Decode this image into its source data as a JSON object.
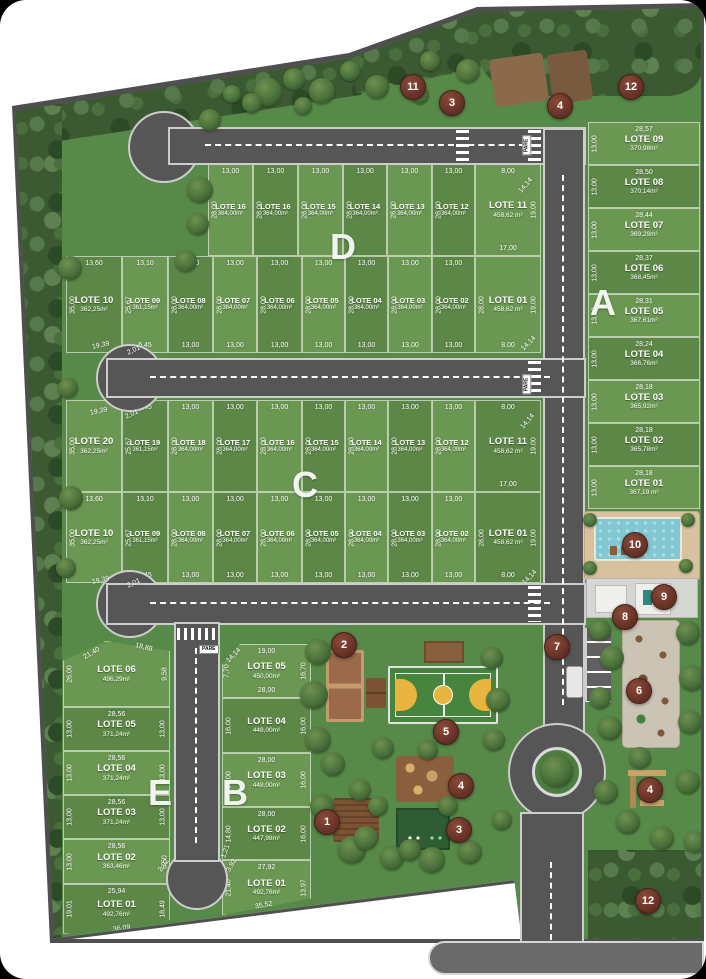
{
  "site": {
    "pare_label": "PARE"
  },
  "blocks": [
    {
      "letter": "A",
      "lx": 590,
      "ly": 282,
      "lots": [
        {
          "n": "LOTE 09",
          "a": "370,98m²",
          "t": "28,57",
          "l": "13,00",
          "x": 588,
          "y": 122,
          "w": 112,
          "h": 43
        },
        {
          "n": "LOTE 08",
          "a": "370,14m²",
          "t": "28,50",
          "l": "13,00",
          "x": 588,
          "y": 165,
          "w": 112,
          "h": 43
        },
        {
          "n": "LOTE 07",
          "a": "369,29m²",
          "t": "28,44",
          "l": "13,00",
          "x": 588,
          "y": 208,
          "w": 112,
          "h": 43
        },
        {
          "n": "LOTE 06",
          "a": "368,45m²",
          "t": "28,37",
          "l": "13,00",
          "x": 588,
          "y": 251,
          "w": 112,
          "h": 43
        },
        {
          "n": "LOTE 05",
          "a": "367,61m²",
          "t": "28,31",
          "l": "13,00",
          "x": 588,
          "y": 294,
          "w": 112,
          "h": 43
        },
        {
          "n": "LOTE 04",
          "a": "366,76m²",
          "t": "28,24",
          "l": "13,00",
          "x": 588,
          "y": 337,
          "w": 112,
          "h": 43
        },
        {
          "n": "LOTE 03",
          "a": "365,92m²",
          "t": "28,18",
          "l": "13,00",
          "x": 588,
          "y": 380,
          "w": 112,
          "h": 43
        },
        {
          "n": "LOTE 02",
          "a": "365,78m²",
          "t": "28,18",
          "l": "13,00",
          "x": 588,
          "y": 423,
          "w": 112,
          "h": 43
        },
        {
          "n": "LOTE 01",
          "a": "367,19 m²",
          "t": "28,18",
          "l": "13,00",
          "x": 588,
          "y": 466,
          "w": 112,
          "h": 43
        }
      ]
    },
    {
      "letter": "D",
      "lx": 330,
      "ly": 226,
      "lots": [
        {
          "n": "LOTE 16",
          "a": "364,00m²",
          "t": "13,00",
          "l": "28,00",
          "x": 208,
          "y": 164,
          "w": 45,
          "h": 92
        },
        {
          "n": "LOTE 16",
          "a": "364,00m²",
          "t": "13,00",
          "l": "28,00",
          "x": 253,
          "y": 164,
          "w": 45,
          "h": 92
        },
        {
          "n": "LOTE 15",
          "a": "364,00m²",
          "t": "13,00",
          "l": "28,00",
          "x": 298,
          "y": 164,
          "w": 45,
          "h": 92
        },
        {
          "n": "LOTE 14",
          "a": "364,00m²",
          "t": "13,00",
          "l": "28,00",
          "x": 343,
          "y": 164,
          "w": 44,
          "h": 92
        },
        {
          "n": "LOTE 13",
          "a": "364,00m²",
          "t": "13,00",
          "l": "28,00",
          "x": 387,
          "y": 164,
          "w": 45,
          "h": 92
        },
        {
          "n": "LOTE 12",
          "a": "364,00m²",
          "t": "13,00",
          "l": "28,00",
          "x": 432,
          "y": 164,
          "w": 43,
          "h": 92
        },
        {
          "n": "LOTE 11",
          "a": "458,62 m²",
          "t": "8,00",
          "r": "19,00",
          "b": "17,00",
          "x": 475,
          "y": 164,
          "w": 66,
          "h": 92
        },
        {
          "n": "LOTE 10",
          "a": "362,25m²",
          "t": "13,60",
          "l": "35,00",
          "x": 66,
          "y": 256,
          "w": 56,
          "h": 97
        },
        {
          "n": "LOTE 09",
          "a": "361,15m²",
          "t": "13,10",
          "l": "25,67",
          "b": "6,45",
          "x": 122,
          "y": 256,
          "w": 46,
          "h": 97
        },
        {
          "n": "LOTE 08",
          "a": "364,00m²",
          "t": "13,00",
          "l": "28,00",
          "b": "13,00",
          "x": 168,
          "y": 256,
          "w": 45,
          "h": 97
        },
        {
          "n": "LOTE 07",
          "a": "364,00m²",
          "t": "13,00",
          "l": "28,00",
          "b": "13,00",
          "x": 213,
          "y": 256,
          "w": 44,
          "h": 97
        },
        {
          "n": "LOTE 06",
          "a": "364,00m²",
          "t": "13,00",
          "l": "28,00",
          "b": "13,00",
          "x": 257,
          "y": 256,
          "w": 45,
          "h": 97
        },
        {
          "n": "LOTE 05",
          "a": "364,00m²",
          "t": "13,00",
          "l": "28,00",
          "b": "13,00",
          "x": 302,
          "y": 256,
          "w": 43,
          "h": 97
        },
        {
          "n": "LOTE 04",
          "a": "364,00m²",
          "t": "13,00",
          "l": "28,00",
          "b": "13,00",
          "x": 345,
          "y": 256,
          "w": 43,
          "h": 97
        },
        {
          "n": "LOTE 03",
          "a": "364,00m²",
          "t": "13,00",
          "l": "28,00",
          "b": "13,00",
          "x": 388,
          "y": 256,
          "w": 44,
          "h": 97
        },
        {
          "n": "LOTE 02",
          "a": "364,00m²",
          "t": "13,00",
          "l": "28,00",
          "b": "13,00",
          "x": 432,
          "y": 256,
          "w": 43,
          "h": 97
        },
        {
          "n": "LOTE 01",
          "a": "458,62 m²",
          "l": "28,00",
          "r": "19,00",
          "b": "8,00",
          "x": 475,
          "y": 256,
          "w": 66,
          "h": 97
        }
      ]
    },
    {
      "letter": "C",
      "lx": 292,
      "ly": 464,
      "lots": [
        {
          "n": "LOTE 20",
          "a": "362,25m²",
          "l": "35,00",
          "x": 66,
          "y": 400,
          "w": 56,
          "h": 92
        },
        {
          "n": "LOTE 19",
          "a": "361,15m²",
          "t": "6,45",
          "l": "25,67",
          "x": 122,
          "y": 400,
          "w": 46,
          "h": 92
        },
        {
          "n": "LOTE 18",
          "a": "364,00m²",
          "t": "13,00",
          "l": "28,00",
          "x": 168,
          "y": 400,
          "w": 45,
          "h": 92
        },
        {
          "n": "LOTE 17",
          "a": "364,00m²",
          "t": "13,00",
          "l": "28,00",
          "x": 213,
          "y": 400,
          "w": 44,
          "h": 92
        },
        {
          "n": "LOTE 16",
          "a": "364,00m²",
          "t": "13,00",
          "l": "28,00",
          "x": 257,
          "y": 400,
          "w": 45,
          "h": 92
        },
        {
          "n": "LOTE 15",
          "a": "364,00m²",
          "t": "13,00",
          "l": "28,00",
          "x": 302,
          "y": 400,
          "w": 43,
          "h": 92
        },
        {
          "n": "LOTE 14",
          "a": "364,00m²",
          "t": "13,00",
          "l": "28,00",
          "x": 345,
          "y": 400,
          "w": 43,
          "h": 92
        },
        {
          "n": "LOTE 13",
          "a": "364,00m²",
          "t": "13,00",
          "l": "28,00",
          "x": 388,
          "y": 400,
          "w": 44,
          "h": 92
        },
        {
          "n": "LOTE 12",
          "a": "364,00m²",
          "t": "13,00",
          "l": "28,00",
          "x": 432,
          "y": 400,
          "w": 43,
          "h": 92
        },
        {
          "n": "LOTE 11",
          "a": "458,62 m²",
          "t": "8,00",
          "r": "19,00",
          "b": "17,00",
          "x": 475,
          "y": 400,
          "w": 66,
          "h": 92
        },
        {
          "n": "LOTE 10",
          "a": "362,25m²",
          "t": "13,60",
          "l": "35,00",
          "x": 66,
          "y": 492,
          "w": 56,
          "h": 91
        },
        {
          "n": "LOTE 09",
          "a": "361,15m²",
          "t": "13,10",
          "l": "25,67",
          "b": "6,45",
          "x": 122,
          "y": 492,
          "w": 46,
          "h": 91
        },
        {
          "n": "LOTE 08",
          "a": "364,00m²",
          "t": "13,00",
          "l": "28,00",
          "b": "13,00",
          "x": 168,
          "y": 492,
          "w": 45,
          "h": 91
        },
        {
          "n": "LOTE 07",
          "a": "364,00m²",
          "t": "13,00",
          "l": "28,00",
          "b": "13,00",
          "x": 213,
          "y": 492,
          "w": 44,
          "h": 91
        },
        {
          "n": "LOTE 06",
          "a": "364,00m²",
          "t": "13,00",
          "l": "28,00",
          "b": "13,00",
          "x": 257,
          "y": 492,
          "w": 45,
          "h": 91
        },
        {
          "n": "LOTE 05",
          "a": "364,00m²",
          "t": "13,00",
          "l": "28,00",
          "b": "13,00",
          "x": 302,
          "y": 492,
          "w": 43,
          "h": 91
        },
        {
          "n": "LOTE 04",
          "a": "364,00m²",
          "t": "13,00",
          "l": "28,00",
          "b": "13,00",
          "x": 345,
          "y": 492,
          "w": 43,
          "h": 91
        },
        {
          "n": "LOTE 03",
          "a": "364,00m²",
          "t": "13,00",
          "l": "28,00",
          "b": "13,00",
          "x": 388,
          "y": 492,
          "w": 44,
          "h": 91
        },
        {
          "n": "LOTE 02",
          "a": "364,00m²",
          "t": "13,00",
          "l": "28,00",
          "b": "13,00",
          "x": 432,
          "y": 492,
          "w": 43,
          "h": 91
        },
        {
          "n": "LOTE 01",
          "a": "458,62 m²",
          "l": "28,00",
          "r": "19,00",
          "b": "8,00",
          "x": 475,
          "y": 492,
          "w": 66,
          "h": 91
        }
      ]
    },
    {
      "letter": "E",
      "lx": 148,
      "ly": 772,
      "lots": [
        {
          "n": "LOTE 06",
          "a": "496,29m²",
          "l": "26,00",
          "r": "9,58",
          "x": 63,
          "y": 641,
          "w": 107,
          "h": 66,
          "clip": "polygon(0 30%, 40% 0, 100% 15%, 100% 100%, 0 100%)"
        },
        {
          "n": "LOTE 05",
          "a": "371,24m²",
          "t": "28,56",
          "l": "13,00",
          "r": "13,00",
          "x": 63,
          "y": 707,
          "w": 107,
          "h": 44
        },
        {
          "n": "LOTE 04",
          "a": "371,24m²",
          "t": "28,56",
          "l": "13,00",
          "r": "13,00",
          "x": 63,
          "y": 751,
          "w": 107,
          "h": 44
        },
        {
          "n": "LOTE 03",
          "a": "371,24m²",
          "t": "28,56",
          "l": "13,00",
          "r": "13,00",
          "x": 63,
          "y": 795,
          "w": 107,
          "h": 44
        },
        {
          "n": "LOTE 02",
          "a": "363,46m²",
          "t": "28,56",
          "l": "13,00",
          "r": "5,50",
          "x": 63,
          "y": 839,
          "w": 107,
          "h": 45
        },
        {
          "n": "LOTE 01",
          "a": "492,76m²",
          "t": "25,94",
          "l": "19,01",
          "r": "18,49",
          "x": 63,
          "y": 884,
          "w": 107,
          "h": 50,
          "clip": "polygon(0 0, 100% 0, 100% 72%, 0 100%)"
        }
      ]
    },
    {
      "letter": "B",
      "lx": 222,
      "ly": 772,
      "lots": [
        {
          "n": "LOTE 05",
          "a": "450,00m²",
          "t": "19,00",
          "l": "7,70",
          "r": "16,70",
          "b": "28,00",
          "x": 222,
          "y": 644,
          "w": 89,
          "h": 54,
          "clip": "polygon(20% 0, 100% 0, 100% 100%, 0 100%, 0 38%)"
        },
        {
          "n": "LOTE 04",
          "a": "448,00m²",
          "l": "16,00",
          "r": "16,00",
          "x": 222,
          "y": 698,
          "w": 89,
          "h": 55
        },
        {
          "n": "LOTE 03",
          "a": "448,00m²",
          "t": "28,00",
          "l": "16,00",
          "r": "16,00",
          "x": 222,
          "y": 753,
          "w": 89,
          "h": 54
        },
        {
          "n": "LOTE 02",
          "a": "447,98m²",
          "t": "28,00",
          "l": "14,80",
          "r": "16,00",
          "x": 222,
          "y": 807,
          "w": 89,
          "h": 53
        },
        {
          "n": "LOTE 01",
          "a": "492,76m²",
          "t": "27,92",
          "l": "21,40",
          "r": "13,97",
          "x": 222,
          "y": 860,
          "w": 89,
          "h": 55,
          "clip": "polygon(0 0, 100% 0, 100% 70%, 0 100%)"
        }
      ]
    }
  ],
  "extra_dims": [
    {
      "t": "14,14",
      "x": 517,
      "y": 182,
      "rot": 50
    },
    {
      "t": "19,39",
      "x": 92,
      "y": 342,
      "rot": 12
    },
    {
      "t": "2,01",
      "x": 127,
      "y": 347,
      "rot": 25
    },
    {
      "t": "14,14",
      "x": 520,
      "y": 340,
      "rot": 45
    },
    {
      "t": "19,39",
      "x": 90,
      "y": 408,
      "rot": 12
    },
    {
      "t": "2,01",
      "x": 125,
      "y": 411,
      "rot": 25
    },
    {
      "t": "14,14",
      "x": 519,
      "y": 418,
      "rot": 50
    },
    {
      "t": "19,39",
      "x": 92,
      "y": 577,
      "rot": 12
    },
    {
      "t": "2,01",
      "x": 127,
      "y": 580,
      "rot": 25
    },
    {
      "t": "14,14",
      "x": 521,
      "y": 574,
      "rot": 45
    },
    {
      "t": "21,40",
      "x": 83,
      "y": 650,
      "rot": 30
    },
    {
      "t": "18,88",
      "x": 135,
      "y": 644,
      "rot": -14
    },
    {
      "t": "2,92",
      "x": 157,
      "y": 862,
      "rot": 55
    },
    {
      "t": "36,09",
      "x": 113,
      "y": 925,
      "rot": 8
    },
    {
      "t": "14,14",
      "x": 225,
      "y": 652,
      "rot": 45
    },
    {
      "t": "1,21",
      "x": 219,
      "y": 848,
      "rot": 70
    },
    {
      "t": "3,92",
      "x": 225,
      "y": 862,
      "rot": 60
    },
    {
      "t": "35,52",
      "x": 255,
      "y": 902,
      "rot": 10
    }
  ],
  "markers": [
    {
      "n": "11",
      "x": 412,
      "y": 86
    },
    {
      "n": "3",
      "x": 451,
      "y": 102
    },
    {
      "n": "4",
      "x": 559,
      "y": 105
    },
    {
      "n": "12",
      "x": 630,
      "y": 86
    },
    {
      "n": "10",
      "x": 634,
      "y": 544
    },
    {
      "n": "9",
      "x": 663,
      "y": 596
    },
    {
      "n": "8",
      "x": 624,
      "y": 616
    },
    {
      "n": "7",
      "x": 556,
      "y": 646
    },
    {
      "n": "6",
      "x": 638,
      "y": 690
    },
    {
      "n": "2",
      "x": 343,
      "y": 644
    },
    {
      "n": "5",
      "x": 445,
      "y": 731
    },
    {
      "n": "4",
      "x": 460,
      "y": 785
    },
    {
      "n": "3",
      "x": 458,
      "y": 829
    },
    {
      "n": "1",
      "x": 326,
      "y": 821
    },
    {
      "n": "4",
      "x": 649,
      "y": 789
    },
    {
      "n": "12",
      "x": 647,
      "y": 900
    }
  ],
  "pare": [
    {
      "x": 517,
      "y": 141,
      "rot": -90
    },
    {
      "x": 517,
      "y": 380,
      "rot": -90
    },
    {
      "x": 199,
      "y": 645,
      "rot": 0
    }
  ],
  "trees": [
    [
      268,
      92,
      14
    ],
    [
      294,
      79,
      11
    ],
    [
      322,
      91,
      13
    ],
    [
      350,
      71,
      10
    ],
    [
      377,
      87,
      12
    ],
    [
      303,
      106,
      9
    ],
    [
      252,
      103,
      10
    ],
    [
      430,
      61,
      10
    ],
    [
      468,
      71,
      12
    ],
    [
      420,
      95,
      9
    ],
    [
      210,
      120,
      11
    ],
    [
      232,
      94,
      9
    ],
    [
      200,
      190,
      13
    ],
    [
      198,
      224,
      11
    ],
    [
      186,
      261,
      11
    ],
    [
      70,
      268,
      12
    ],
    [
      68,
      388,
      10
    ],
    [
      71,
      498,
      12
    ],
    [
      66,
      568,
      10
    ],
    [
      318,
      652,
      13
    ],
    [
      314,
      695,
      14
    ],
    [
      318,
      740,
      13
    ],
    [
      333,
      764,
      12
    ],
    [
      383,
      748,
      11
    ],
    [
      428,
      750,
      10
    ],
    [
      492,
      658,
      11
    ],
    [
      498,
      700,
      12
    ],
    [
      494,
      740,
      11
    ],
    [
      352,
      850,
      14
    ],
    [
      392,
      858,
      12
    ],
    [
      432,
      860,
      13
    ],
    [
      470,
      852,
      12
    ],
    [
      378,
      806,
      10
    ],
    [
      360,
      790,
      11
    ],
    [
      448,
      806,
      10
    ],
    [
      322,
      806,
      12
    ],
    [
      502,
      820,
      10
    ],
    [
      366,
      838,
      12
    ],
    [
      410,
      850,
      11
    ],
    [
      600,
      630,
      11
    ],
    [
      612,
      658,
      12
    ],
    [
      600,
      698,
      11
    ],
    [
      610,
      728,
      12
    ],
    [
      688,
      633,
      12
    ],
    [
      692,
      678,
      13
    ],
    [
      690,
      722,
      12
    ],
    [
      640,
      758,
      11
    ],
    [
      606,
      792,
      12
    ],
    [
      628,
      822,
      12
    ],
    [
      688,
      782,
      12
    ],
    [
      662,
      838,
      12
    ],
    [
      695,
      842,
      11
    ],
    [
      590,
      520,
      7
    ],
    [
      688,
      520,
      7
    ],
    [
      590,
      568,
      7
    ],
    [
      686,
      566,
      7
    ]
  ]
}
